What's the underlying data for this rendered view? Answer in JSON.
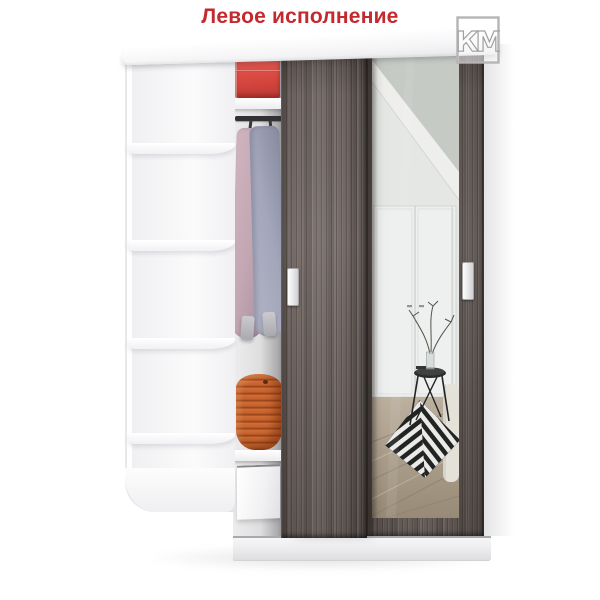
{
  "title": {
    "text": "Левое исполнение"
  },
  "logo": {
    "text": "КМ"
  },
  "colors": {
    "accent_red": "#c3292f",
    "box_red": "#d6463e",
    "wood": "#6b615d",
    "wood_dark": "#554c48",
    "basket_orange": "#c4612c",
    "garment_pink": "#c2a7b2",
    "garment_blue": "#a3a6ba",
    "mirror_wall": "#e9ebe8",
    "floor_wood": "#ab9c88",
    "rug_black": "#1b1b1b"
  }
}
